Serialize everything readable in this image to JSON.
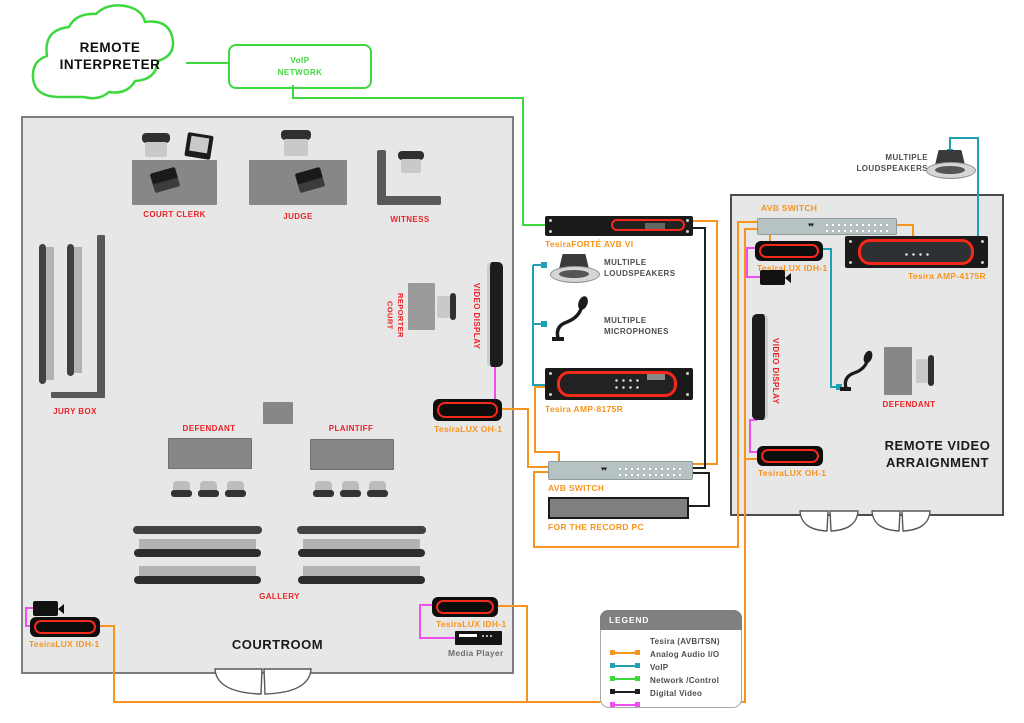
{
  "cloud": {
    "label": "REMOTE INTERPRETER"
  },
  "voip_network": {
    "label": "VoIP NETWORK"
  },
  "courtroom": {
    "title": "COURTROOM",
    "court_clerk": "COURT CLERK",
    "judge": "JUDGE",
    "witness": "WITNESS",
    "jury_box": "JURY BOX",
    "court_reporter": "COURT REPORTER",
    "video_display": "VIDEO DISPLAY",
    "defendant": "DEFENDANT",
    "plaintiff": "PLAINTIFF",
    "gallery": "GALLERY",
    "oh1_label": "TesiraLUX OH-1",
    "idh1_left_label": "TesiraLUX IDH-1",
    "idh1_right_label": "TesiraLUX IDH-1",
    "media_player_label": "Media Player"
  },
  "rack_center": {
    "forte_label": "TesiraFORTÉ AVB VI",
    "loudspeakers_label": "MULTIPLE LOUDSPEAKERS",
    "microphones_label": "MULTIPLE MICROPHONES",
    "amp_label": "Tesira AMP-8175R",
    "switch_label": "AVB SWITCH",
    "pc_label": "FOR THE RECORD PC"
  },
  "remote_arraignment": {
    "title": "REMOTE VIDEO ARRAIGNMENT",
    "loudspeakers_label": "MULTIPLE LOUDSPEAKERS",
    "switch_label": "AVB SWITCH",
    "idh1_label": "TesiraLUX IDH-1",
    "amp_label": "Tesira AMP-4175R",
    "video_display": "VIDEO DISPLAY",
    "defendant": "DEFENDANT",
    "oh1_label": "TesiraLUX OH-1"
  },
  "legend": {
    "title": "LEGEND",
    "items": [
      {
        "label": "Tesira (AVB/TSN)",
        "color": "#F7941D"
      },
      {
        "label": "Analog Audio I/O",
        "color": "#1FA0B5"
      },
      {
        "label": "VoIP",
        "color": "#3DD83D"
      },
      {
        "label": "Network /Control",
        "color": "#231F20"
      },
      {
        "label": "Digital Video",
        "color": "#F04FF0"
      }
    ]
  }
}
